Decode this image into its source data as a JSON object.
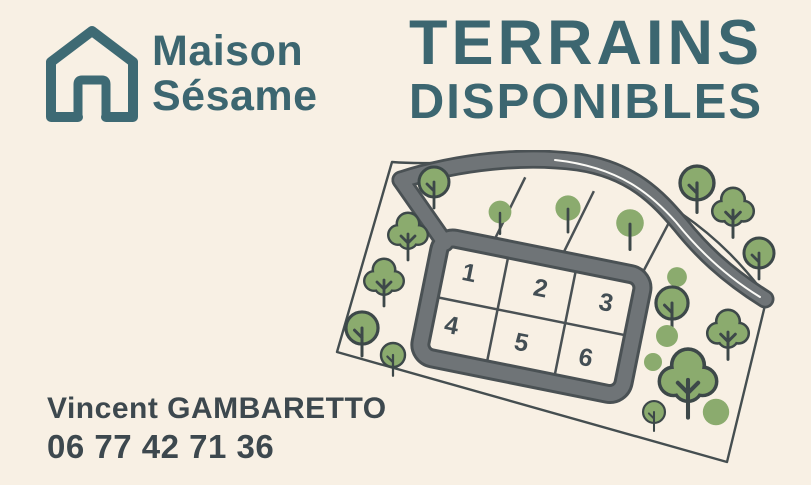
{
  "brand": {
    "line1": "Maison",
    "line2": "Sésame"
  },
  "headline": {
    "line1": "TERRAINS",
    "line2": "DISPONIBLES"
  },
  "contact": {
    "name": "Vincent GAMBARETTO",
    "phone": "06 77 42 71 36"
  },
  "map": {
    "plot_labels": [
      "1",
      "2",
      "3",
      "4",
      "5",
      "6"
    ]
  },
  "colors": {
    "background": "#f8f0e4",
    "teal": "#3c6670",
    "slate_text": "#3d484e",
    "road_fill": "#6f7477",
    "road_casing": "#4a5154",
    "tree_green": "#8bab6e",
    "tree_outline": "#3d4849",
    "boundary_line": "#454e50",
    "road_center_line": "#fbfaf6"
  }
}
